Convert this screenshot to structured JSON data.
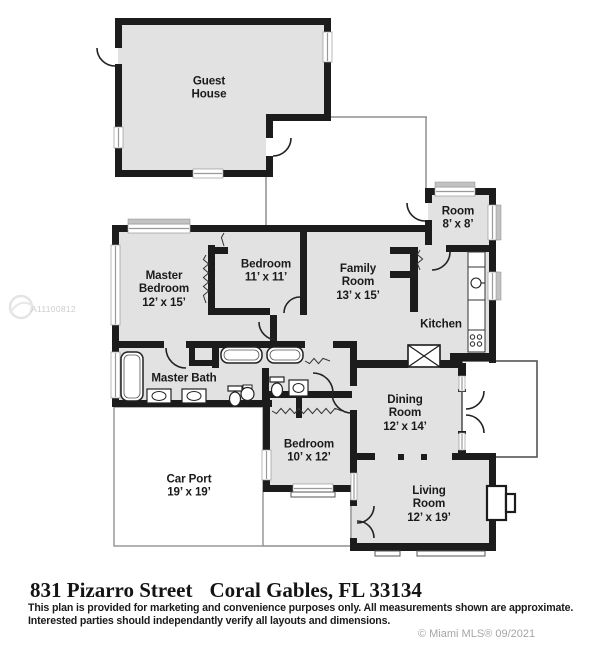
{
  "plan_rooms": {
    "guest_house": {
      "line1": "Guest",
      "line2": "House"
    },
    "master_bedroom": {
      "line1": "Master",
      "line2": "Bedroom",
      "line3": "12’ x 15’"
    },
    "bedroom_11": {
      "line1": "Bedroom",
      "line2": "11’ x 11’"
    },
    "family_room": {
      "line1": "Family",
      "line2": "Room",
      "line3": "13’ x 15’"
    },
    "room_8": {
      "line1": "Room",
      "line2": "8’ x 8’"
    },
    "kitchen": {
      "line1": "Kitchen"
    },
    "master_bath": {
      "line1": "Master Bath"
    },
    "bedroom_10": {
      "line1": "Bedroom",
      "line2": "10’ x 12’"
    },
    "dining_room": {
      "line1": "Dining",
      "line2": "Room",
      "line3": "12’ x 14’"
    },
    "car_port": {
      "line1": "Car Port",
      "line2": "19’ x 19’"
    },
    "living_room": {
      "line1": "Living",
      "line2": "Room",
      "line3": "12’ x 19’"
    }
  },
  "footer": {
    "address_street": "831 Pizarro Street",
    "address_city": "Coral Gables, FL 33134",
    "disclaimer_line1": "This plan is provided for marketing and convenience purposes only. All measurements shown are approximate.",
    "disclaimer_line2": "Interested parties should independantly verify all layouts and dimensions."
  },
  "watermarks": {
    "mls_number": "A11100812",
    "credit": "© Miami MLS® 09/2021"
  },
  "colors": {
    "wall": "#1c1c1c",
    "floor": "#e2e2e3",
    "thin_line": "#999999",
    "porch_line": "#555555"
  }
}
